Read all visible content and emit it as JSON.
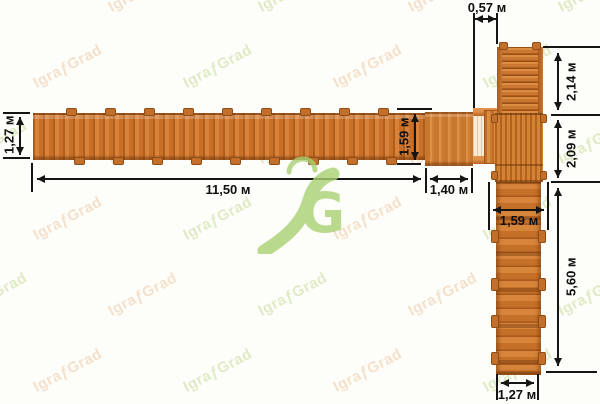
{
  "brand": {
    "watermark_text": "IgraƒGrad",
    "logo_letter": "G",
    "logo_color": "#a9d171"
  },
  "colors": {
    "dimension_line": "#151515",
    "wood_base": "#c86f28",
    "background": "#fdfdf9"
  },
  "dimensions": {
    "top_connector_width": "0,57 м",
    "ladder_length": "2,14 м",
    "deck_length": "2,09 м",
    "walkway_width": "1,27 м",
    "walkway_length": "11,50 м",
    "platform_length": "1,40 м",
    "platform_width": "1,59 м",
    "lower_walkway_width": "1,59 м",
    "lower_walkway_length": "5,60 м",
    "lower_walkway_end_width": "1,27 м"
  }
}
